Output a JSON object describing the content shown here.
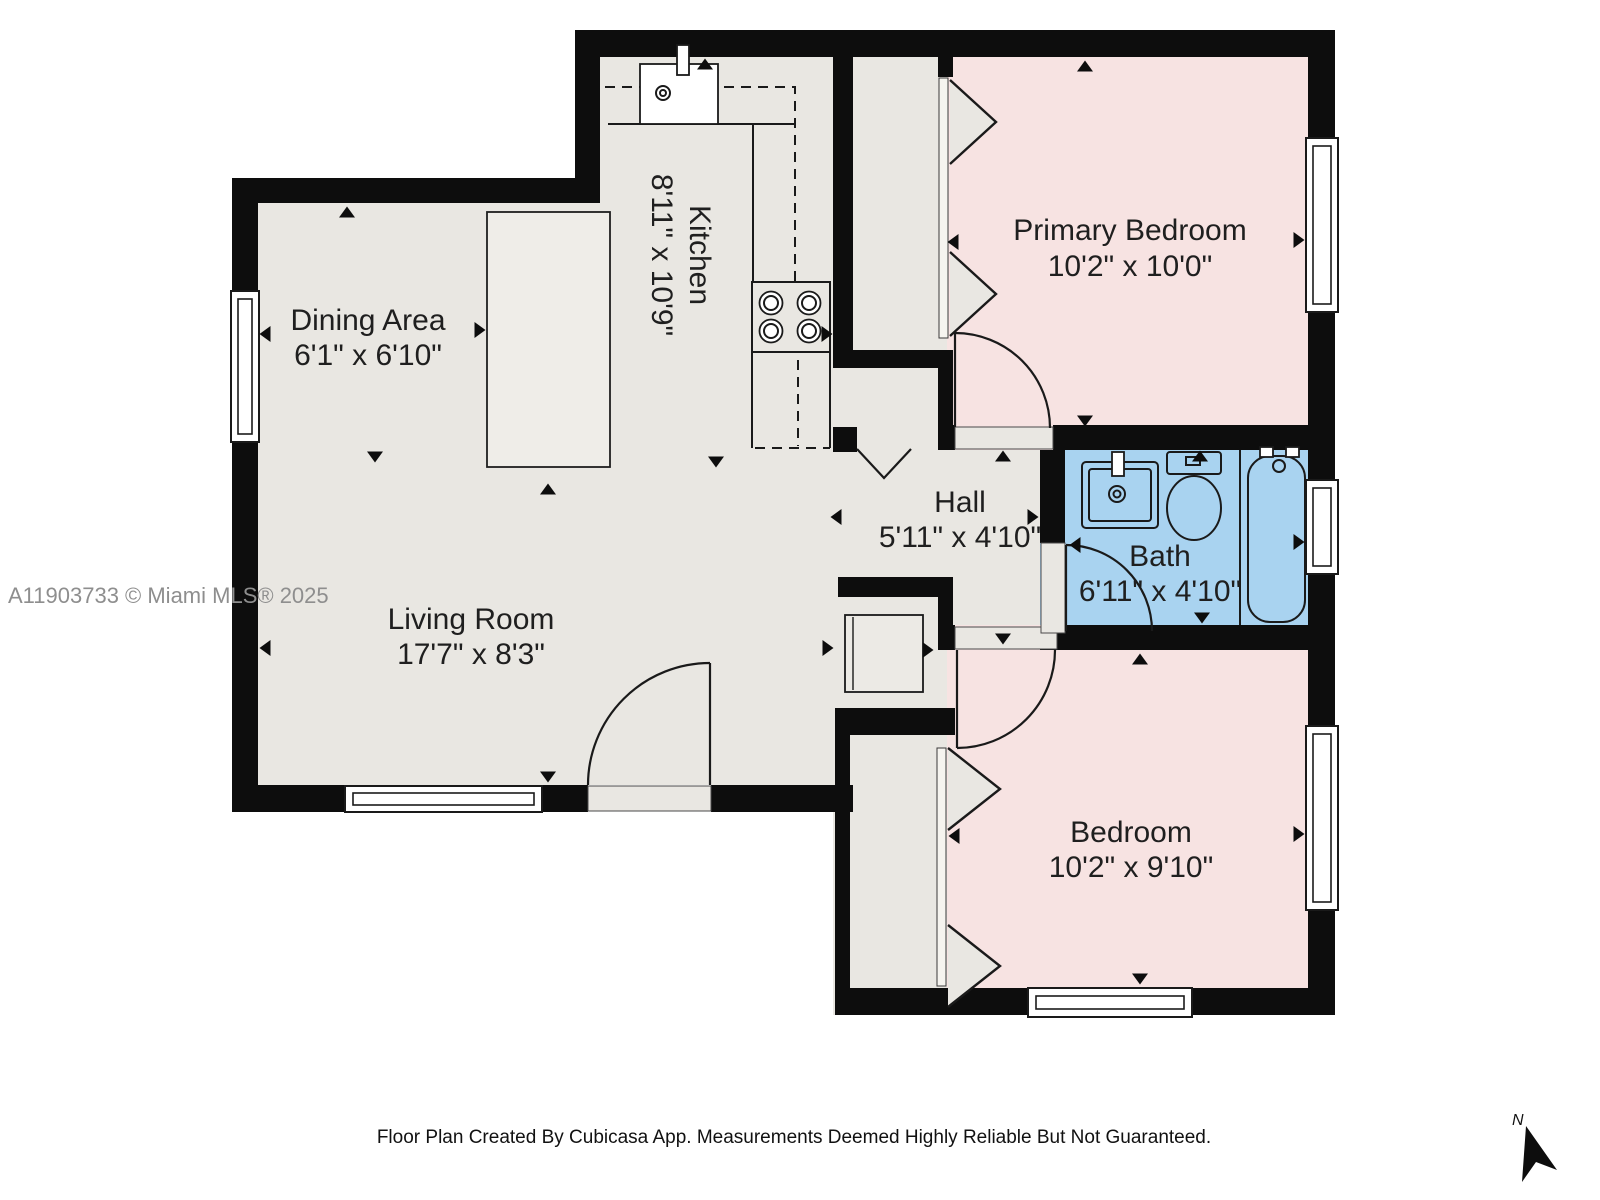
{
  "floor_plan": {
    "watermark": "A11903733 © Miami MLS® 2025",
    "footer": "Floor Plan Created By Cubicasa App. Measurements Deemed Highly Reliable But Not Guaranteed.",
    "compass_label": "N",
    "rooms": {
      "dining": {
        "name": "Dining Area",
        "dims": "6'1\" x 6'10\""
      },
      "kitchen": {
        "name": "Kitchen",
        "dims": "8'11\" x 10'9\""
      },
      "primary": {
        "name": "Primary Bedroom",
        "dims": "10'2\" x 10'0\""
      },
      "hall": {
        "name": "Hall",
        "dims": "5'11\" x 4'10\""
      },
      "bath": {
        "name": "Bath",
        "dims": "6'11\" x 4'10\""
      },
      "living": {
        "name": "Living Room",
        "dims": "17'7\" x 8'3\""
      },
      "bedroom": {
        "name": "Bedroom",
        "dims": "10'2\" x 9'10\""
      }
    },
    "colors": {
      "wall": "#0d0d0d",
      "floor_gray": "#e9e7e2",
      "bedroom_pink": "#f7e3e2",
      "bath_blue": "#a9d3f0",
      "watermark_gray": "#8e8e8e"
    }
  }
}
